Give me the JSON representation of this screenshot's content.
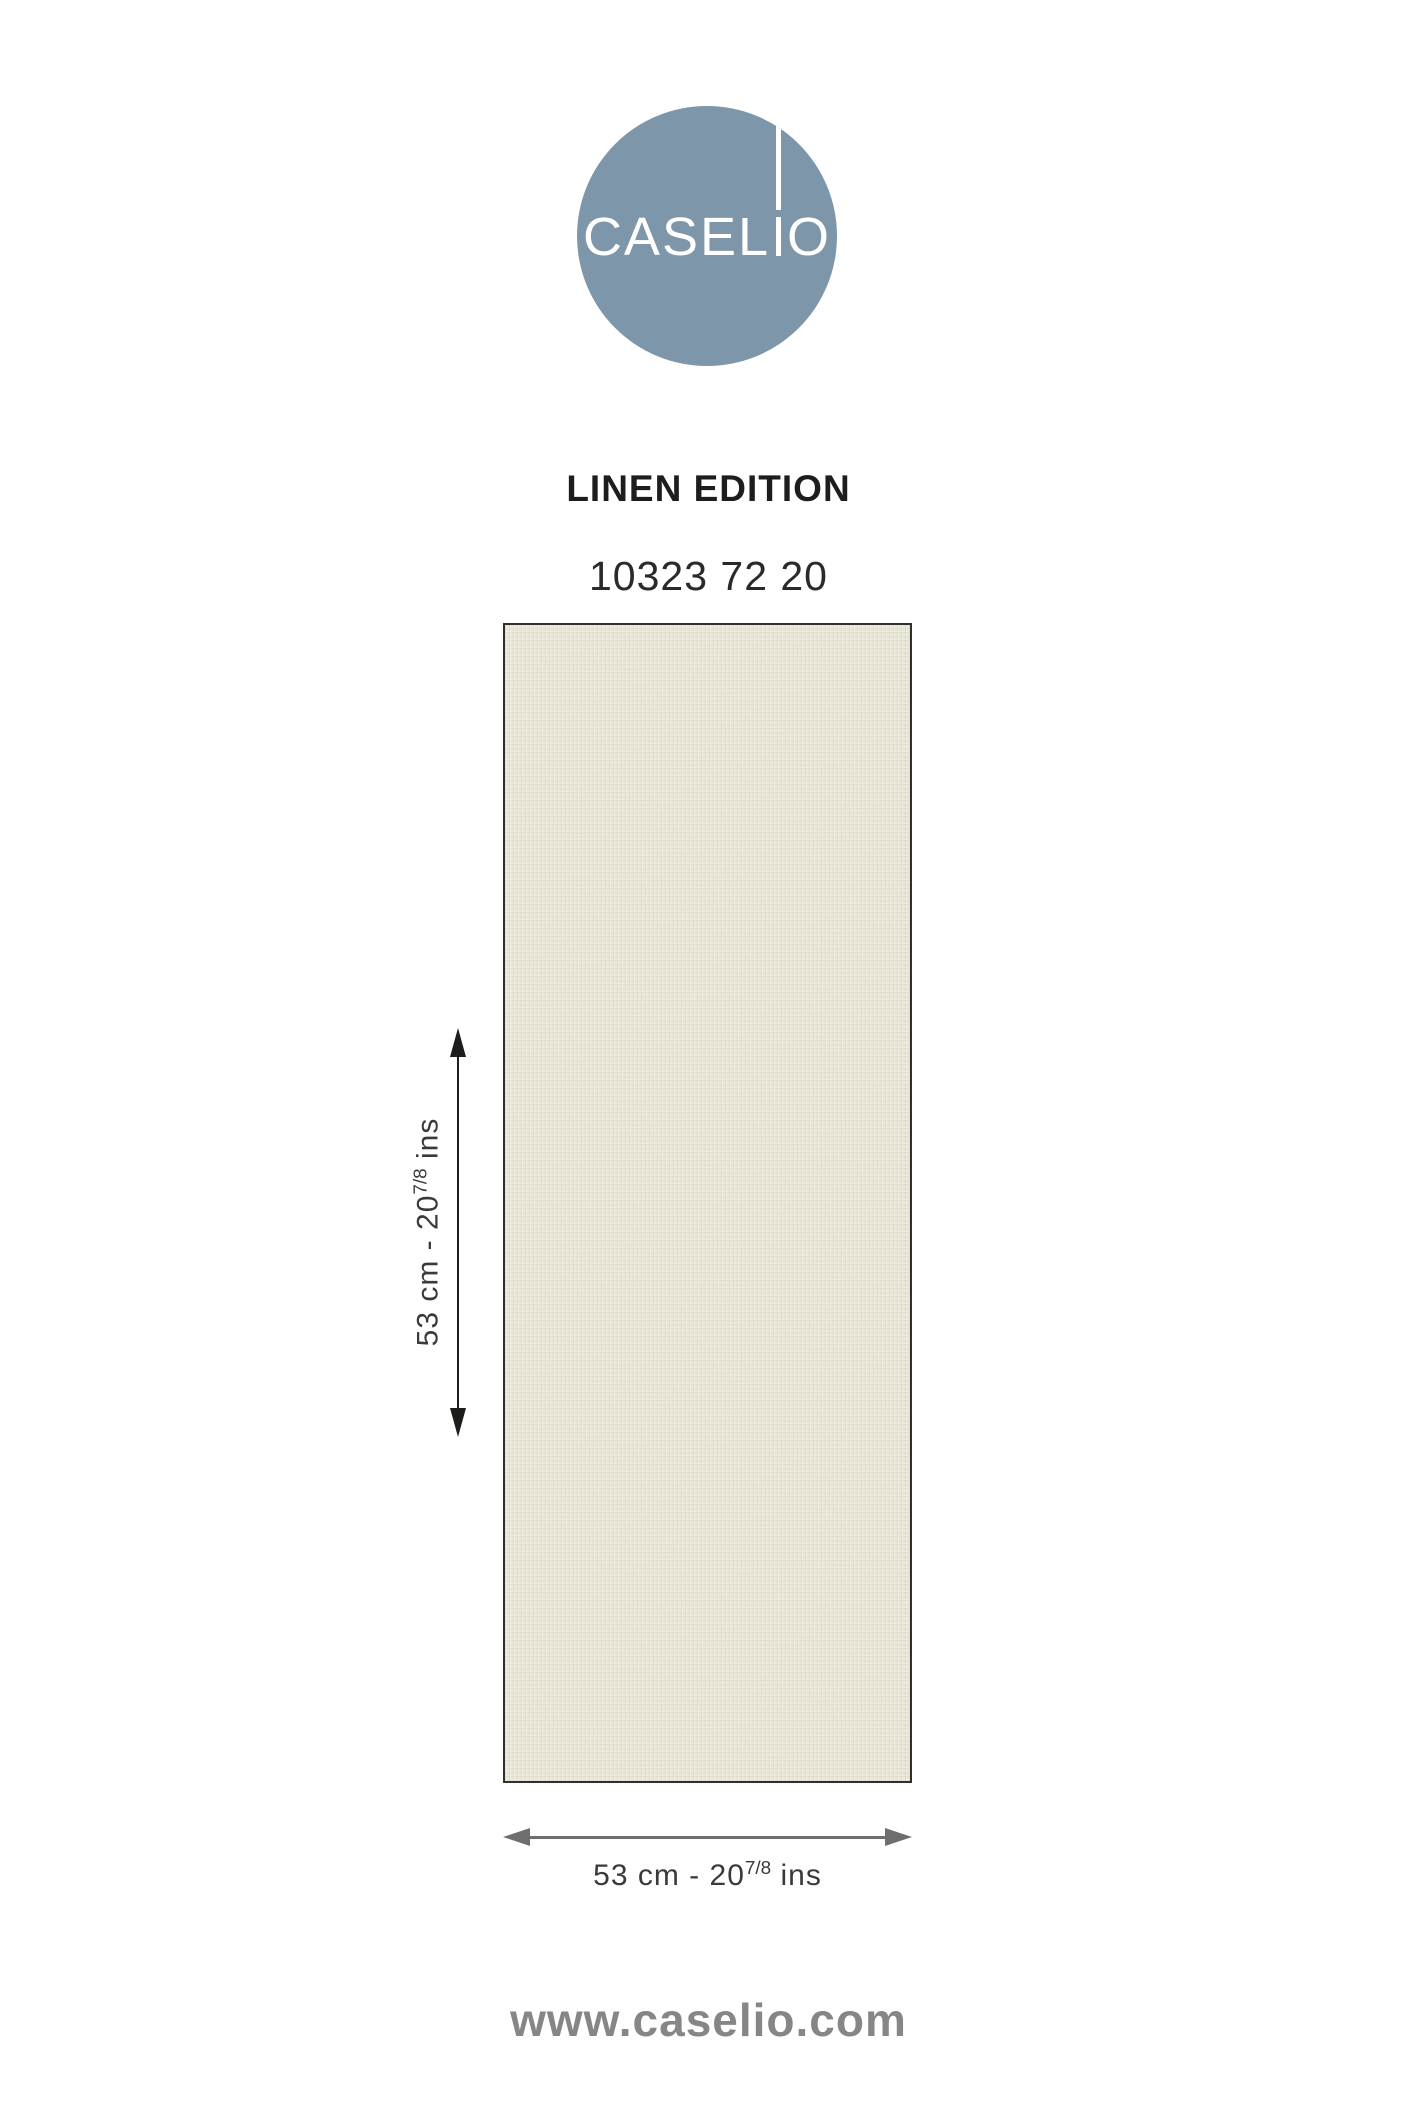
{
  "brand": {
    "logo_full": "CASELIO",
    "logo_prefix": "CASEL",
    "logo_suffix": "O"
  },
  "product": {
    "collection_title": "LINEN EDITION",
    "reference_number": "10323 72 20"
  },
  "swatch": {
    "description": "plain cream linen-weave wallpaper swatch"
  },
  "dimensions": {
    "vertical": {
      "prefix": "53 cm - 20",
      "fraction": "7/8",
      "suffix": " ins"
    },
    "horizontal": {
      "prefix": "53 cm - 20",
      "fraction": "7/8",
      "suffix": " ins"
    }
  },
  "footer": {
    "website_url": "www.caselio.com"
  },
  "colors": {
    "circle": "#7e96aa",
    "logo_text": "#ffffff",
    "title": "#1d1d1b",
    "reference": "#2a2a2a",
    "swatch_base": "#e9e6d6",
    "swatch_border": "#30302e",
    "vertical_arrow": "#1d1d1b",
    "horizontal_arrow": "#6e6e6e",
    "dimension_text": "#3a3a3a",
    "footer": "#868686"
  }
}
